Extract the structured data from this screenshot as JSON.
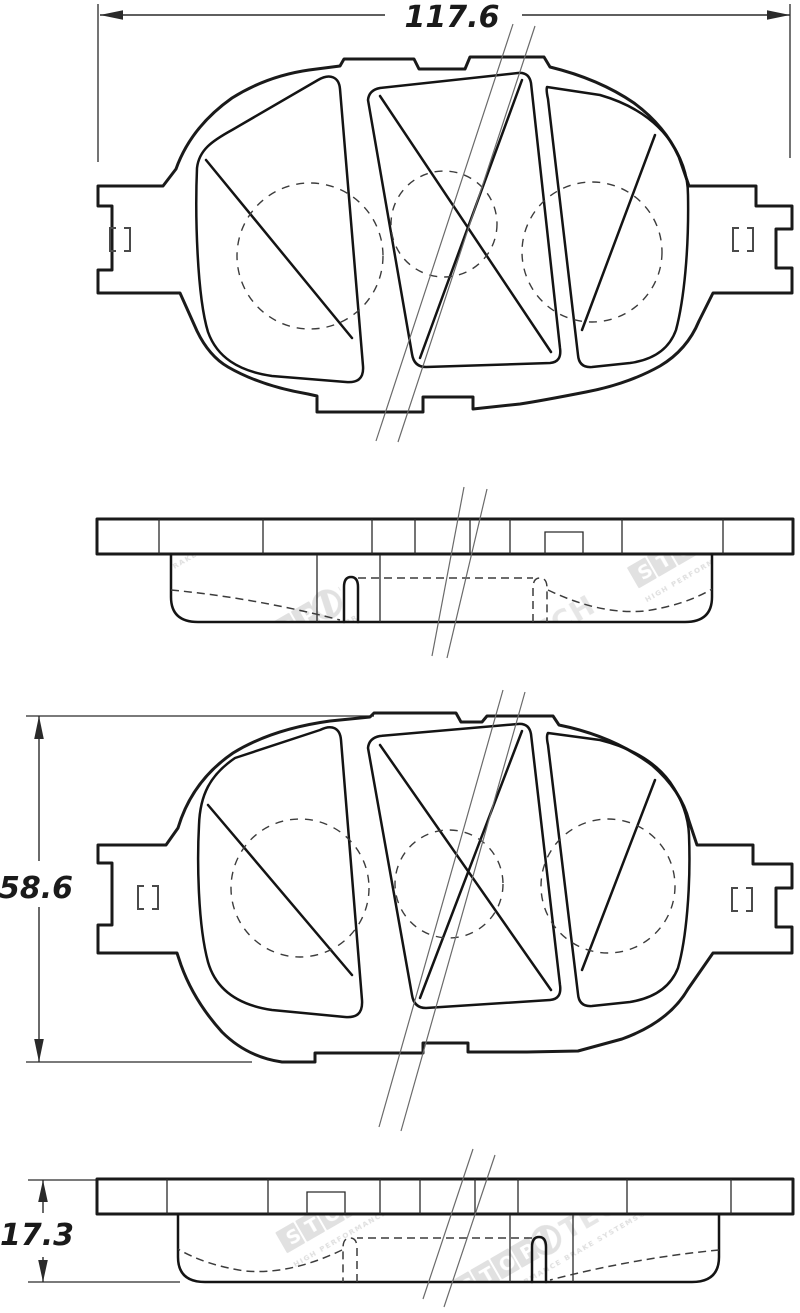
{
  "dimensions": {
    "width": "117.6",
    "height": "58.6",
    "thickness": "17.3"
  },
  "watermark": {
    "stop": "STOP",
    "tech": "TECH",
    "tagline": "HIGH PERFORMANCE BRAKE SYSTEMS®"
  },
  "colors": {
    "outline": "#1a1a1a",
    "thin_line": "#2a2a2a",
    "watermark_gray": "#c9c9c9",
    "background": "#ffffff"
  }
}
